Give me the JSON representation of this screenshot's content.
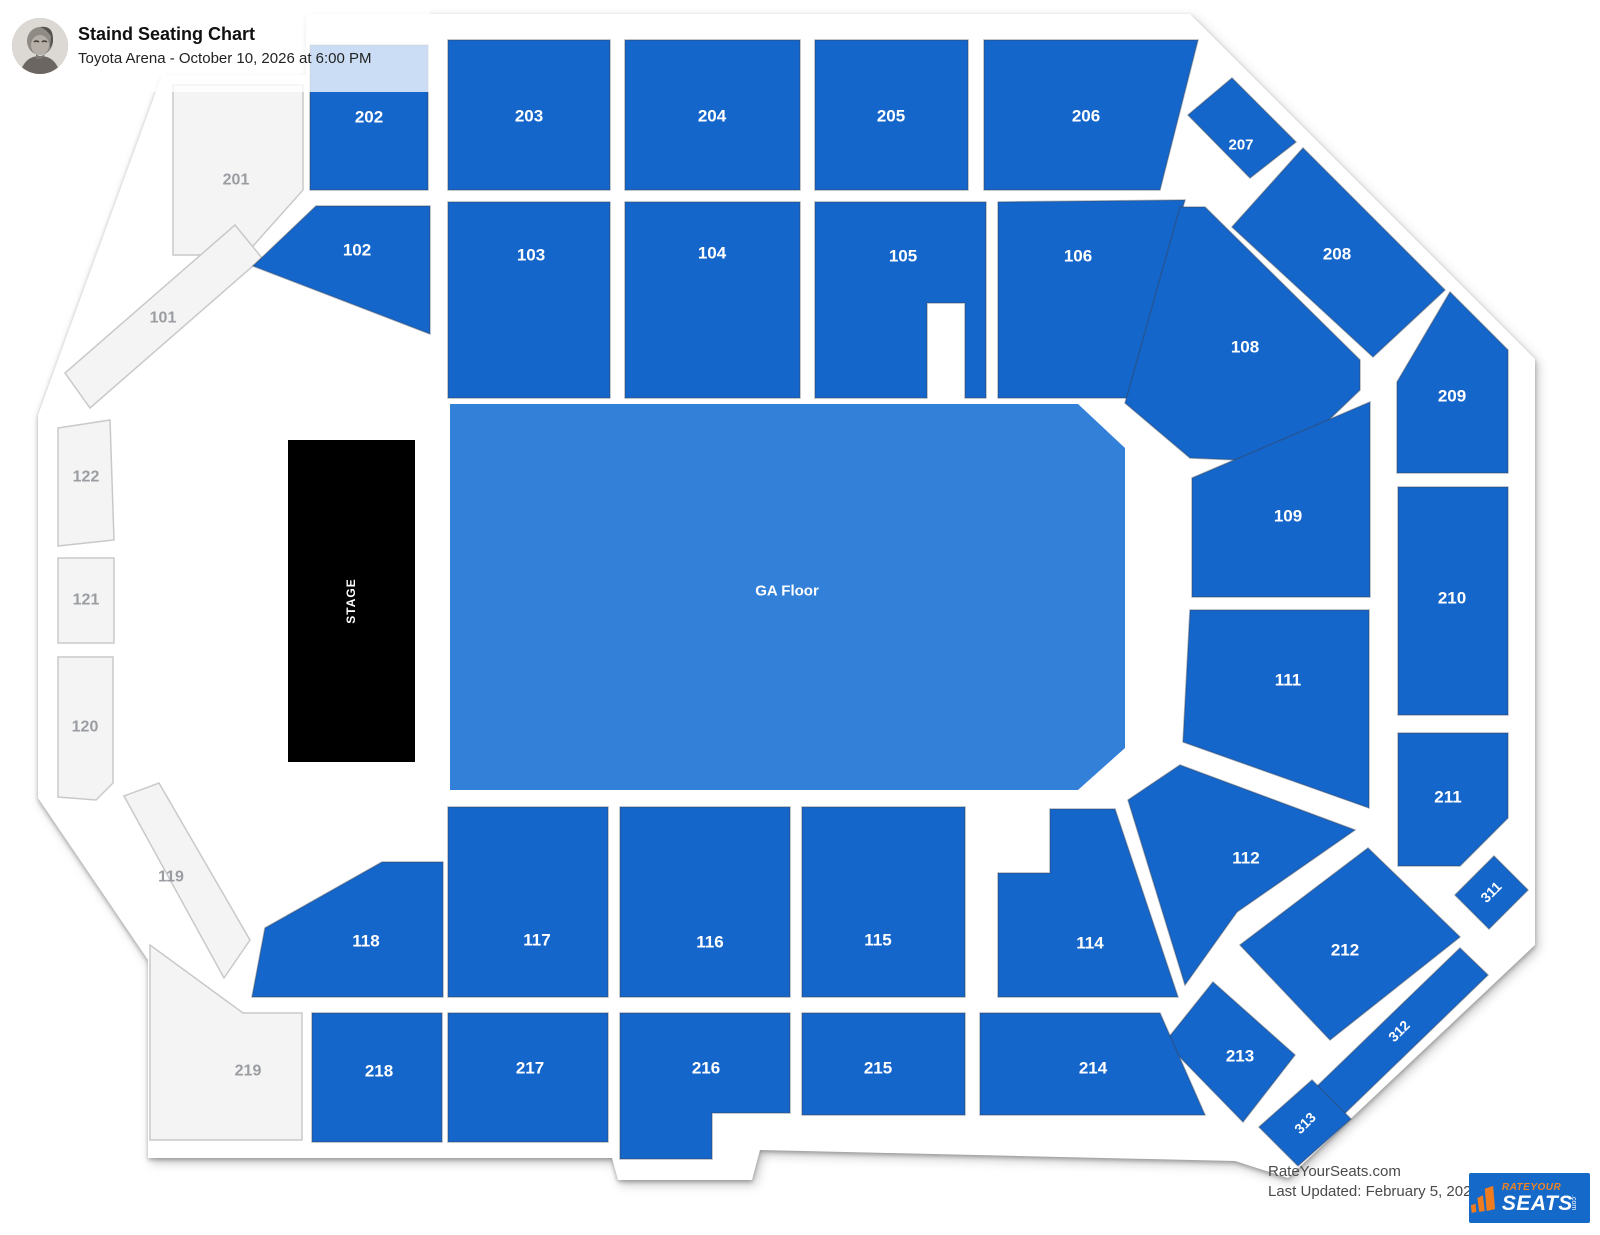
{
  "header": {
    "title": "Staind Seating Chart",
    "subtitle": "Toyota Arena - October 10, 2026 at 6:00 PM"
  },
  "footer": {
    "site_line": "RateYourSeats.com",
    "updated_line": "Last Updated: February 5, 2026",
    "logo_top": "RATEYOUR",
    "logo_main": "SEATS",
    "logo_com": ".com"
  },
  "colors": {
    "available": "#1566cb",
    "available_stroke": "rgba(55,65,80,0.40)",
    "ga_floor": "#3380d8",
    "stage": "#000000",
    "unavailable_fill": "#f4f4f4",
    "unavailable_border": "#c9c9c9",
    "unavailable_label": "#9a9da1",
    "section_label": "#ffffff",
    "outline_band": "#ffffff"
  },
  "map": {
    "canvas": {
      "width": 1600,
      "height": 1235
    },
    "outline_path": "M 306,14 L 1190,14 L 1535,359 L 1535,945 L 1288,1178 L 1235,1161 L 760,1150 L 752,1180 L 618,1180 L 612,1158 L 148,1158 L 148,960 L 38,798 L 38,415 L 162,75 L 306,75 Z",
    "sections": [
      {
        "id": "201",
        "label": "201",
        "state": "unavailable",
        "points": "173,85 303,85 303,190 245,255 173,255",
        "label_x": 236,
        "label_y": 180,
        "rotation": 0,
        "font_size": 16
      },
      {
        "id": "101",
        "label": "101",
        "state": "unavailable",
        "points": "235,225 262,258 90,408 65,373",
        "label_x": 163,
        "label_y": 318,
        "rotation": 0,
        "font_size": 16
      },
      {
        "id": "122",
        "label": "122",
        "state": "unavailable",
        "points": "58,428 110,420 114,540 58,546",
        "label_x": 86,
        "label_y": 477,
        "rotation": 0,
        "font_size": 16
      },
      {
        "id": "121",
        "label": "121",
        "state": "unavailable",
        "points": "58,558 114,558 114,643 58,643",
        "label_x": 86,
        "label_y": 600,
        "rotation": 0,
        "font_size": 16
      },
      {
        "id": "120",
        "label": "120",
        "state": "unavailable",
        "points": "58,657 113,657 113,783 96,800 58,797",
        "label_x": 85,
        "label_y": 727,
        "rotation": 0,
        "font_size": 16
      },
      {
        "id": "119",
        "label": "119",
        "state": "unavailable",
        "points": "124,796 159,783 250,940 224,978",
        "label_x": 171,
        "label_y": 877,
        "rotation": 0,
        "font_size": 16
      },
      {
        "id": "219",
        "label": "219",
        "state": "unavailable",
        "points": "150,945 243,1013 302,1013 302,1140 150,1140",
        "label_x": 248,
        "label_y": 1071,
        "rotation": 0,
        "font_size": 16
      },
      {
        "id": "202",
        "label": "202",
        "state": "available",
        "points": "310,45 428,45 428,190 310,190",
        "label_x": 369,
        "label_y": 117,
        "rotation": 0,
        "font_size": 17
      },
      {
        "id": "203",
        "label": "203",
        "state": "available",
        "points": "448,40 610,40 610,190 448,190",
        "label_x": 529,
        "label_y": 116,
        "rotation": 0,
        "font_size": 17
      },
      {
        "id": "204",
        "label": "204",
        "state": "available",
        "points": "625,40 800,40 800,190 625,190",
        "label_x": 712,
        "label_y": 116,
        "rotation": 0,
        "font_size": 17
      },
      {
        "id": "205",
        "label": "205",
        "state": "available",
        "points": "815,40 968,40 968,190 815,190",
        "label_x": 891,
        "label_y": 116,
        "rotation": 0,
        "font_size": 17
      },
      {
        "id": "206",
        "label": "206",
        "state": "available",
        "points": "984,40 1198,40 1160,190 984,190",
        "label_x": 1086,
        "label_y": 116,
        "rotation": 0,
        "font_size": 17
      },
      {
        "id": "207",
        "label": "207",
        "state": "available",
        "points": "1232,78 1296,142 1250,178 1188,115",
        "label_x": 1241,
        "label_y": 145,
        "rotation": 0,
        "font_size": 15
      },
      {
        "id": "208",
        "label": "208",
        "state": "available",
        "points": "1303,148 1445,290 1373,357 1232,227",
        "label_x": 1337,
        "label_y": 254,
        "rotation": 0,
        "font_size": 17
      },
      {
        "id": "209",
        "label": "209",
        "state": "available",
        "points": "1397,382 1450,292 1508,350 1508,473 1397,473",
        "label_x": 1452,
        "label_y": 396,
        "rotation": 0,
        "font_size": 17
      },
      {
        "id": "210",
        "label": "210",
        "state": "available",
        "points": "1398,487 1508,487 1508,715 1398,715",
        "label_x": 1452,
        "label_y": 598,
        "rotation": 0,
        "font_size": 17
      },
      {
        "id": "211",
        "label": "211",
        "state": "available",
        "points": "1398,733 1508,733 1508,818 1460,866 1398,866",
        "label_x": 1448,
        "label_y": 797,
        "rotation": 0,
        "font_size": 17
      },
      {
        "id": "311",
        "label": "311",
        "state": "available",
        "points": "1455,895 1494,856 1528,890 1489,929",
        "label_x": 1491,
        "label_y": 892,
        "rotation": -45,
        "font_size": 14
      },
      {
        "id": "212",
        "label": "212",
        "state": "available",
        "points": "1240,945 1368,848 1460,937 1330,1040",
        "label_x": 1345,
        "label_y": 950,
        "rotation": 0,
        "font_size": 17
      },
      {
        "id": "312",
        "label": "312",
        "state": "available",
        "points": "1460,948 1488,975 1338,1120 1310,1093",
        "label_x": 1399,
        "label_y": 1031,
        "rotation": -45,
        "font_size": 14
      },
      {
        "id": "313",
        "label": "313",
        "state": "available",
        "points": "1312,1080 1351,1119 1298,1166 1259,1127",
        "label_x": 1305,
        "label_y": 1123,
        "rotation": -45,
        "font_size": 14
      },
      {
        "id": "213",
        "label": "213",
        "state": "available",
        "points": "1213,982 1295,1055 1243,1122 1165,1042",
        "label_x": 1240,
        "label_y": 1056,
        "rotation": 0,
        "font_size": 17
      },
      {
        "id": "214",
        "label": "214",
        "state": "available",
        "points": "980,1013 1160,1013 1205,1115 980,1115",
        "label_x": 1093,
        "label_y": 1068,
        "rotation": 0,
        "font_size": 17
      },
      {
        "id": "215",
        "label": "215",
        "state": "available",
        "points": "802,1013 965,1013 965,1115 802,1115",
        "label_x": 878,
        "label_y": 1068,
        "rotation": 0,
        "font_size": 17
      },
      {
        "id": "216",
        "label": "216",
        "state": "available",
        "points": "620,1013 790,1013 790,1113 712,1113 712,1159 620,1159",
        "label_x": 706,
        "label_y": 1068,
        "rotation": 0,
        "font_size": 17
      },
      {
        "id": "217",
        "label": "217",
        "state": "available",
        "points": "448,1013 608,1013 608,1142 448,1142",
        "label_x": 530,
        "label_y": 1068,
        "rotation": 0,
        "font_size": 17
      },
      {
        "id": "218",
        "label": "218",
        "state": "available",
        "points": "312,1013 442,1013 442,1142 312,1142",
        "label_x": 379,
        "label_y": 1071,
        "rotation": 0,
        "font_size": 17
      },
      {
        "id": "102",
        "label": "102",
        "state": "available",
        "points": "316,206 430,206 430,334 253,266",
        "label_x": 357,
        "label_y": 250,
        "rotation": 0,
        "font_size": 17
      },
      {
        "id": "103",
        "label": "103",
        "state": "available",
        "points": "448,202 610,202 610,398 448,398",
        "label_x": 531,
        "label_y": 255,
        "rotation": 0,
        "font_size": 17
      },
      {
        "id": "104",
        "label": "104",
        "state": "available",
        "points": "625,202 800,202 800,398 625,398",
        "label_x": 712,
        "label_y": 253,
        "rotation": 0,
        "font_size": 17
      },
      {
        "id": "105",
        "label": "105",
        "state": "available",
        "points": "815,202 986,202 986,398 965,398 965,303 927,303 927,398 815,398",
        "label_x": 903,
        "label_y": 256,
        "rotation": 0,
        "font_size": 17
      },
      {
        "id": "106",
        "label": "106",
        "state": "available",
        "points": "998,202 1185,200 1127,398 998,398",
        "label_x": 1078,
        "label_y": 256,
        "rotation": 0,
        "font_size": 17
      },
      {
        "id": "108",
        "label": "108",
        "state": "available",
        "points": "1180,207 1205,207 1360,360 1360,390 1285,462 1190,458 1125,403",
        "label_x": 1245,
        "label_y": 347,
        "rotation": 0,
        "font_size": 17
      },
      {
        "id": "109",
        "label": "109",
        "state": "available",
        "points": "1192,478 1370,402 1370,597 1192,597",
        "label_x": 1288,
        "label_y": 516,
        "rotation": 0,
        "font_size": 17
      },
      {
        "id": "111",
        "label": "111",
        "state": "available",
        "points": "1190,610 1369,610 1369,808 1183,742",
        "label_x": 1288,
        "label_y": 680,
        "rotation": 0,
        "font_size": 17
      },
      {
        "id": "112",
        "label": "112",
        "state": "available",
        "points": "1180,765 1355,830 1237,912 1185,985 1128,800",
        "label_x": 1246,
        "label_y": 858,
        "rotation": 0,
        "font_size": 17
      },
      {
        "id": "118",
        "label": "118",
        "state": "available",
        "points": "382,862 443,862 443,997 252,997 265,928",
        "label_x": 366,
        "label_y": 941,
        "rotation": 0,
        "font_size": 17
      },
      {
        "id": "117",
        "label": "117",
        "state": "available",
        "points": "448,807 608,807 608,997 448,997",
        "label_x": 537,
        "label_y": 940,
        "rotation": 0,
        "font_size": 17
      },
      {
        "id": "116",
        "label": "116",
        "state": "available",
        "points": "620,807 790,807 790,997 620,997",
        "label_x": 710,
        "label_y": 942,
        "rotation": 0,
        "font_size": 17
      },
      {
        "id": "115",
        "label": "115",
        "state": "available",
        "points": "802,807 965,807 965,997 802,997",
        "label_x": 878,
        "label_y": 940,
        "rotation": 0,
        "font_size": 17
      },
      {
        "id": "114",
        "label": "114",
        "state": "available",
        "points": "998,873 1050,873 1050,809 1115,809 1178,997 998,997",
        "label_x": 1090,
        "label_y": 943,
        "rotation": 0,
        "font_size": 17
      },
      {
        "id": "ga-floor",
        "label": "GA Floor",
        "state": "ga",
        "points": "450,404 1078,404 1125,448 1125,748 1078,790 450,790",
        "label_x": 787,
        "label_y": 591,
        "rotation": 0,
        "font_size": 15
      },
      {
        "id": "stage",
        "label": "STAGE",
        "state": "stage",
        "points": "288,440 415,440 415,762 288,762",
        "label_x": 351,
        "label_y": 601,
        "rotation": -90,
        "font_size": 12
      }
    ]
  }
}
